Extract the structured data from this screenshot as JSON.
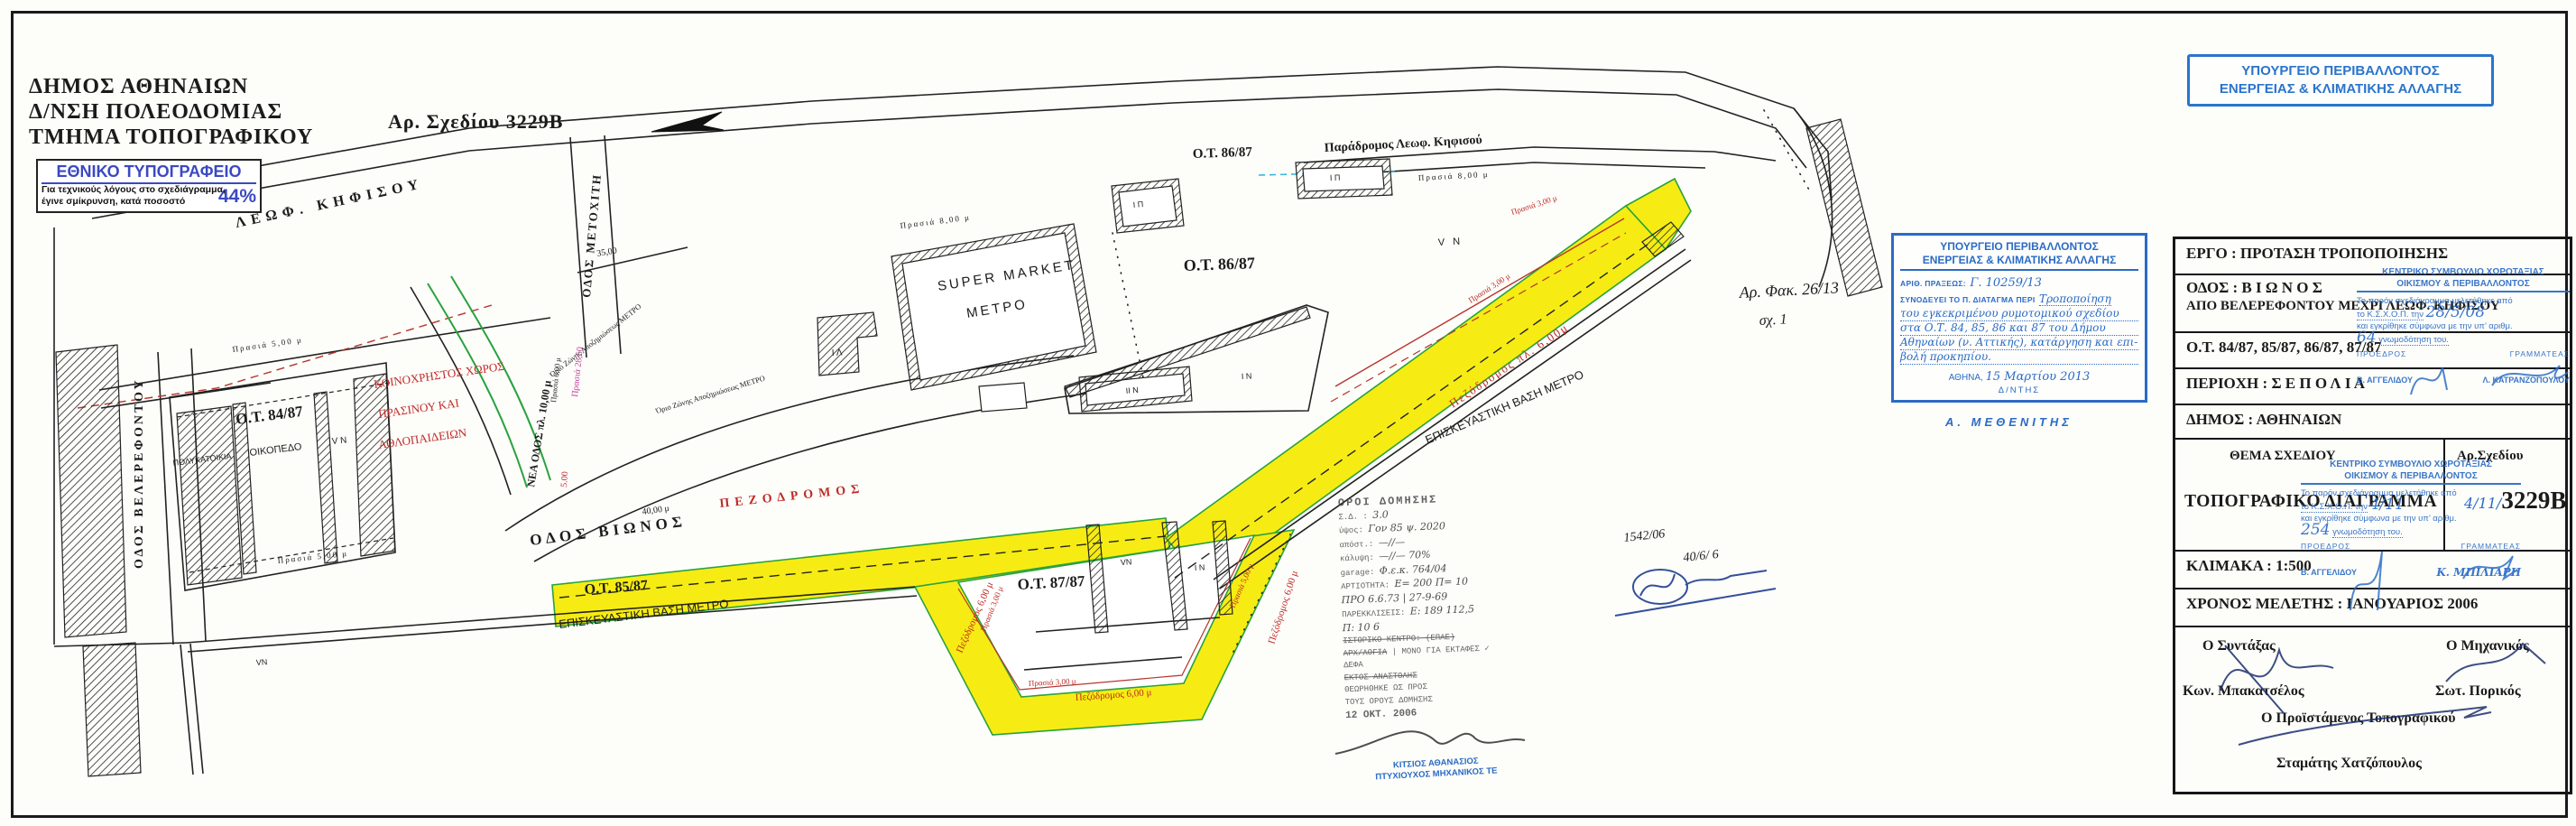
{
  "header": {
    "line1": "ΔΗΜΟΣ ΑΘΗΝΑΙΩΝ",
    "line2": "Δ/ΝΣΗ ΠΟΛΕΟΔΟΜΙΑΣ",
    "line3": "ΤΜΗΜΑ ΤΟΠΟΓΡΑΦΙΚΟΥ",
    "drawing_no": "Αρ. Σχεδίου 3229Β"
  },
  "reduction_box": {
    "title": "ΕΘΝΙΚΟ ΤΥΠΟΓΡΑΦΕΙΟ",
    "line1": "Για τεχνικούς λόγους στο σχεδιάγραμμα,",
    "line2": "έγινε σμίκρυνση, κατά ποσοστό",
    "percent": "44%"
  },
  "ministry_badge": {
    "line1": "ΥΠΟΥΡΓΕΙΟ ΠΕΡΙΒΑΛΛΟΝΤΟΣ",
    "line2": "ΕΝΕΡΓΕΙΑΣ & ΚΛΙΜΑΤΙΚΗΣ ΑΛΛΑΓΗΣ"
  },
  "decree_stamp": {
    "line1": "ΥΠΟΥΡΓΕΙΟ ΠΕΡΙΒΑΛΛΟΝΤΟΣ",
    "line2": "ΕΝΕΡΓΕΙΑΣ & ΚΛΙΜΑΤΙΚΗΣ ΑΛΛΑΓΗΣ",
    "praxis_label": "ΑΡΙΘ. ΠΡΑΞΕΩΣ:",
    "praxis_value": "Γ. 10259/13",
    "decree_label": "ΣΥΝΟΔΕΥΕΙ ΤΟ Π. ΔΙΑΤΑΓΜΑ ΠΕΡΙ",
    "text1": "Τροποποίηση",
    "text2": "του εγκεκριμένου ρυμοτομικού σχεδίου",
    "text3": "στα Ο.Τ. 84, 85, 86 και 87 του Δήμου",
    "text4": "Αθηναίων (ν. Αττικής), κατάργηση και επι-",
    "text5": "βολή προκηπίου.",
    "city_label": "ΑΘΗΝΑ,",
    "date_value": "15 Μαρτίου 2013",
    "director": "Δ/ΝΤΗΣ",
    "signature_name": "Α. ΜΕΘΕΝΙΤΗΣ"
  },
  "titleblock": {
    "row_ergo": "ΕΡΓΟ : ΠΡΟΤΑΣΗ ΤΡΟΠΟΠΟΙΗΣΗΣ",
    "row_odos1": "ΟΔΟΣ : Β Ι Ω Ν Ο Σ",
    "row_odos2": "ΑΠΟ ΒΕΛΕΡΕΦΟΝΤΟΥ ΜΕΧΡΙ ΛΕΩΦ. ΚΗΦΙΣΟΥ",
    "row_ot": "Ο.Τ. 84/87, 85/87, 86/87, 87/87",
    "row_periochi": "ΠΕΡΙΟΧΗ : Σ Ε Π Ο Λ Ι Α",
    "row_dimos": "ΔΗΜΟΣ : ΑΘΗΝΑΙΩΝ",
    "thema_label": "ΘΕΜΑ ΣΧΕΔΙΟΥ",
    "arsxediou_label": "Αρ.Σχεδίου",
    "thema_value": "ΤΟΠΟΓΡΑΦΙΚΟ ΔΙΑΓΡΑΜΜΑ",
    "arsxediou_value": "3229Β",
    "arsxediou_hand": "4/11/",
    "row_klimaka": "ΚΛΙΜΑΚΑ : 1:500",
    "row_xronos": "ΧΡΟΝΟΣ ΜΕΛΕΤΗΣ : ΙΑΝΟΥΑΡΙΟΣ  2006",
    "sig_syntaxas_label": "Ο Συντάξας",
    "sig_syntaxas_name": "Κων. Μπακατσέλος",
    "sig_mixanikos_label": "Ο Μηχανικός",
    "sig_mixanikos_name": "Σωτ. Πορικός",
    "sig_proistamenos_label": "Ο Προϊστάμενος Τοπογραφικού",
    "sig_proistamenos_name": "Σταμάτης Χατζόπουλος"
  },
  "approval_stamp_upper": {
    "line1": "ΚΕΝΤΡΙΚΟ ΣΥΜΒΟΥΛΙΟ ΧΩΡΟΤΑΞΙΑΣ",
    "line2": "ΟΙΚΙΣΜΟΥ & ΠΕΡΙΒΑΛΛΟΝΤΟΣ",
    "line3": "Το παρόν σχεδιάγραμμα μελετήθηκε από",
    "line4a": "το Κ.Σ.Χ.Ο.Π. την",
    "date_hand": "28/5/08",
    "line5": "και εγκρίθηκε σύμφωνα με την υπ’ αριθμ.",
    "num_hand": "64",
    "line6": "γνωμοδότηση του.",
    "proedros": "ΠΡΟΕΔΡΟΣ",
    "grammateas": "ΓΡΑΜΜΑΤΕΑΣ",
    "name1": "Β. ΑΓΓΕΛΙΔΟΥ",
    "name2": "Λ. ΚΑΤΡΑΝΖΟΠΟΥΛΟΥ"
  },
  "approval_stamp_lower": {
    "line1": "ΚΕΝΤΡΙΚΟ ΣΥΜΒΟΥΛΙΟ ΧΩΡΟΤΑΞΙΑΣ",
    "line2": "ΟΙΚΙΣΜΟΥ & ΠΕΡΙΒΑΛΛΟΝΤΟΣ",
    "line3": "Το παρόν σχεδιάγραμμα μελετήθηκε από",
    "line4a": "το Κ.Σ.Χ.Ο.Π. την",
    "date_hand": "4/11",
    "line5": "και εγκρίθηκε σύμφωνα με την υπ’ αριθμ.",
    "num_hand": "254",
    "line6": "γνωμοδότηση του.",
    "proedros": "ΠΡΟΕΔΡΟΣ",
    "grammateas": "ΓΡΑΜΜΑΤΕΑΣ",
    "name1": "Β. ΑΓΓΕΛΙΔΟΥ",
    "name2": "Κ. ΜΠΙΛΙΑΡΗ"
  },
  "building_terms": {
    "title": "ΟΡΟΙ ΔΟΜΗΣΗΣ",
    "rows": [
      {
        "l": "Σ.Δ. :",
        "v": "3.0"
      },
      {
        "l": "ύψος:",
        "v": "Γον 85 ψ. 2020"
      },
      {
        "l": "απόστ.:",
        "v": "—//—"
      },
      {
        "l": "κάλυψη:",
        "v": "—//—  70%"
      },
      {
        "l": "garage:",
        "v": "Φ.ε.κ. 764/04"
      },
      {
        "l": "ΑΡΤΙΟΤΗΤΑ:",
        "v": "Ε= 200  Π= 10"
      },
      {
        "l": "",
        "v": "ΠΡΟ 6.6.73  |  27-9-69"
      },
      {
        "l": "ΠΑΡΕΚΚΛΙΣΕΙΣ:",
        "v": "Ε: 189   112,5"
      },
      {
        "l": "",
        "v": "Π: 10      6"
      }
    ],
    "struck1": "ΙΣΤΟΡΙΚΟ ΚΕΝΤΡΟ: (ΕΠΑΕ)",
    "struck2": "ΑΡΧ/ΛΟΓΙΑ",
    "note": "ΜΟΝΟ ΓΙΑ ΕΚΤΑΦΕΣ",
    "check": "✓",
    "defa": "ΔΕΦΑ",
    "struck3": "ΕΚΤΟΣ ΑΝΑΣΤΟΛΗΣ",
    "approved1": "ΘΕΩΡΗΘΗΚΕ ΩΣ ΠΡΟΣ",
    "approved2": "ΤΟΥΣ ΟΡΟΥΣ ΔΟΜΗΣΗΣ",
    "date": "12 ΟΚΤ. 2006",
    "engineer1": "ΚΙΤΣΙΟΣ ΑΘΑΝΑΣΙΟΣ",
    "engineer2": "ΠΤΥΧΙΟΥΧΟΣ ΜΗΧΑΝΙΚΟΣ ΤΕ"
  },
  "handnotes": {
    "file1": "Αρ. Φακ. 26/13",
    "file2": "σχ. 1",
    "blue1": "1542/06",
    "blue2": "40/6/ 6"
  },
  "map": {
    "labels": [
      {
        "t": "ΛΕΩΦ.  ΚΗΦΙΣΟΥ"
      },
      {
        "t": "Παράδρομος Λεωφ. Κηφισού"
      },
      {
        "t": "ΟΔΟΣ  ΒΕΛΕΡΕΦΟΝΤΟΥ"
      },
      {
        "t": "ΟΔΟΣ  ΜΕΤΟΧΙΤΗ"
      },
      {
        "t": "ΝΕΑ ΟΔΟΣ πλ. 10,00 μ"
      },
      {
        "t": "ΟΔΟΣ  ΒΙΩΝΟΣ"
      },
      {
        "t": "ΠΕΖΟΔΡΟΜΟΣ"
      },
      {
        "t": "Πεζόδρομος πλ. 6,00μ"
      },
      {
        "t": "Πεζόδρομος 6,00 μ"
      },
      {
        "t": "Πεζόδρομος 6,00 μ"
      },
      {
        "t": "Πεζόδρομος 6,00 μ"
      },
      {
        "t": "Ο.Τ. 84/87"
      },
      {
        "t": "Ο.Τ. 85/87"
      },
      {
        "t": "Ο.Τ. 86/87"
      },
      {
        "t": "Ο.Τ. 86/87"
      },
      {
        "t": "Ο.Τ. 87/87"
      },
      {
        "t": "SUPER MARKET"
      },
      {
        "t": "ΜΕΤΡΟ"
      },
      {
        "t": "ΕΠΙΣΚΕΥΑΣΤΙΚΗ ΒΑΣΗ ΜΕΤΡΟ"
      },
      {
        "t": "ΕΠΙΣΚΕΥΑΣΤΙΚΗ ΒΑΣΗ ΜΕΤΡΟ"
      },
      {
        "t": "ΚΟΙΝΟΧΡΗΣΤΟΣ ΧΩΡΟΣ"
      },
      {
        "t": "ΠΡΑΣΙΝΟΥ ΚΑΙ"
      },
      {
        "t": "ΑΘΛΟΠΑΙΔΕΙΩΝ"
      },
      {
        "t": "ΠΟΛΥΚΑΤΟΙΚΙΑ"
      },
      {
        "t": "ΟΙΚΟΠΕΔΟ"
      },
      {
        "t": "Πρασιά 5,00 μ"
      },
      {
        "t": "Πρασιά 5,00 μ"
      },
      {
        "t": "Πρασιά 8,00 μ"
      },
      {
        "t": "Πρασιά 8,00 μ"
      },
      {
        "t": "Πρασιά 3,00 μ"
      },
      {
        "t": "Πρασιά 3,00 μ"
      },
      {
        "t": "Πρασιά 3,00 μ"
      },
      {
        "t": "Πρασιά 3,00 μ"
      },
      {
        "t": "Πρασιά 5,00 μ"
      },
      {
        "t": "Πρασιά 28,50"
      },
      {
        "t": "5.00"
      },
      {
        "t": "35,00"
      },
      {
        "t": "40,00 μ"
      },
      {
        "t": "Πρασιά 6,00 μ"
      },
      {
        "t": "V N"
      },
      {
        "t": "V N"
      },
      {
        "t": "VΝ"
      },
      {
        "t": "Ι Ν"
      },
      {
        "t": "Ι Ν"
      },
      {
        "t": "Ι Λ"
      },
      {
        "t": "Ι Π"
      },
      {
        "t": "Ι Π"
      },
      {
        "t": "ΙΙ Ν"
      },
      {
        "t": "Όριο Ζώνης Αποζημιώσεως ΜΕΤΡΟ"
      },
      {
        "t": "Όριο Ζώνης Αποζημιώσεως ΜΕΤΡΟ"
      },
      {
        "t": "VΝ"
      }
    ]
  },
  "colors": {
    "stamp_blue": "#2a6bc5",
    "badge_blue": "#2a74cc",
    "highlight_yellow": "#f6ec13",
    "red_annotation": "#bf2b26",
    "magenta_annotation": "#c43f9f",
    "green_line": "#2aa23e"
  }
}
